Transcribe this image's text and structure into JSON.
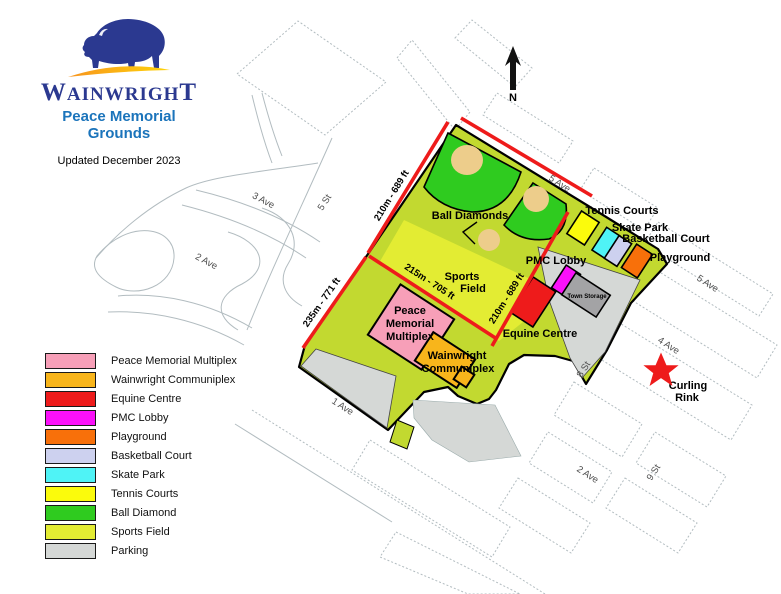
{
  "header": {
    "wordmark": {
      "first": "W",
      "middle": "AINWRIGH",
      "last": "T"
    },
    "title_line1": "Peace Memorial",
    "title_line2": "Grounds",
    "updated": "Updated December 2023"
  },
  "compass": {
    "north_label": "N"
  },
  "colors": {
    "navy": "#2B3990",
    "gold_left": "#F7941E",
    "gold_right": "#FFD40A",
    "title_blue": "#1B74BB",
    "red": "#EE1B1B",
    "magenta": "#FB10FA",
    "pink": "#F79FB8",
    "amber": "#F8B51B",
    "orange": "#F8700A",
    "lavender": "#CDD1EF",
    "cyan": "#4FF3F6",
    "yellow": "#FBFB0C",
    "green": "#2FCB1F",
    "field": "#E3EC33",
    "grounds": "#C2D930",
    "parking": "#D5D8D6",
    "storage": "#A3A3A5",
    "tan": "#EDCD8B",
    "street": "#B2BCC0",
    "black": "#000000",
    "white": "#FFFFFF"
  },
  "map": {
    "streets": {
      "ave3": "3 Ave",
      "ave2_left": "2 Ave",
      "st5": "5 St",
      "ave5_top": "5 Ave",
      "ave5_right": "5 Ave",
      "ave4": "4 Ave",
      "ave1": "1 Ave",
      "ave2_right": "2 Ave",
      "st8": "8 St",
      "st9": "9 St"
    },
    "dimensions": {
      "nw": "210m - 689 ft",
      "w": "235m - 771 ft",
      "inner_s": "215m - 705 ft",
      "inner_e": "210m - 689 ft"
    },
    "facilities": {
      "ball_diamonds": "Ball Diamonds",
      "sports_field": [
        "Sports",
        "Field"
      ],
      "pmc_lobby": "PMC Lobby",
      "town_storage": "Town Storage",
      "equine_centre": "Equine Centre",
      "tennis_courts": "Tennis Courts",
      "skate_park": "Skate Park",
      "basketball_court": "Basketball Court",
      "playground": "Playground",
      "multiplex": [
        "Peace",
        "Memorial",
        "Multiplex"
      ],
      "communiplex": [
        "Wainwright",
        "Communiplex"
      ],
      "curling_rink": [
        "Curling",
        "Rink"
      ]
    }
  },
  "legend": {
    "items": [
      {
        "label": "Peace Memorial Multiplex",
        "color": "#F79FB8"
      },
      {
        "label": "Wainwright Communiplex",
        "color": "#F8B51B"
      },
      {
        "label": "Equine Centre",
        "color": "#EE1B1B"
      },
      {
        "label": "PMC Lobby",
        "color": "#FB10FA"
      },
      {
        "label": "Playground",
        "color": "#F8700A"
      },
      {
        "label": "Basketball Court",
        "color": "#CDD1EF"
      },
      {
        "label": "Skate Park",
        "color": "#4FF3F6"
      },
      {
        "label": "Tennis Courts",
        "color": "#FBFB0C"
      },
      {
        "label": "Ball Diamond",
        "color": "#2FCB1F"
      },
      {
        "label": "Sports Field",
        "color": "#E3EC33"
      },
      {
        "label": "Parking",
        "color": "#D5D8D6"
      }
    ]
  }
}
